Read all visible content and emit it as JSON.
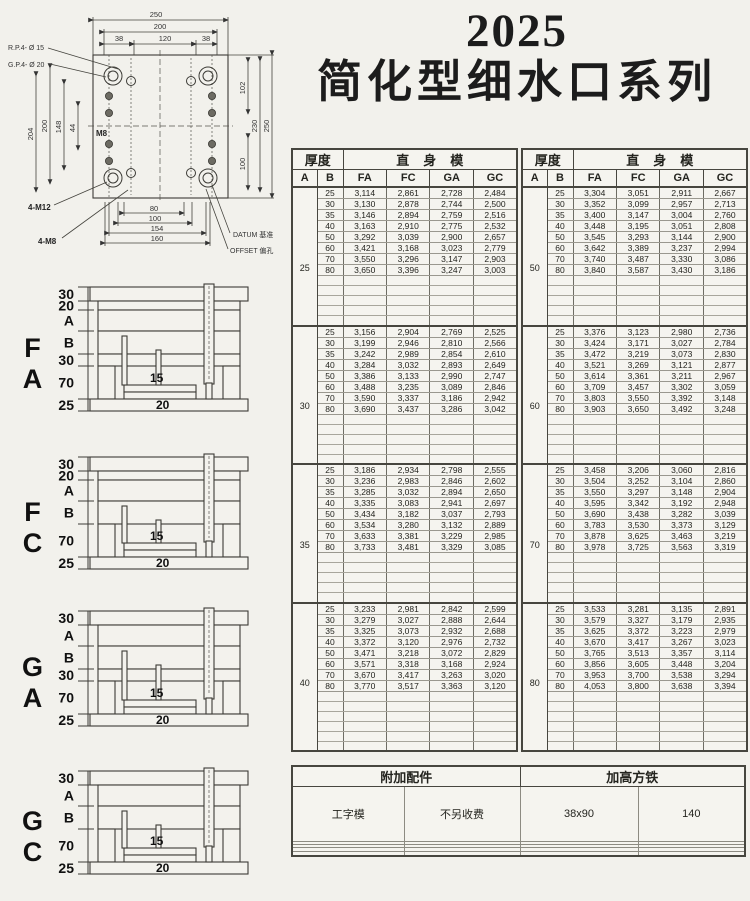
{
  "page": {
    "title_year": "2025",
    "title_main": "简化型细水口系列"
  },
  "drawing": {
    "dims": {
      "t250": "250",
      "t200": "200",
      "t38l": "38",
      "t120": "120",
      "t38r": "38",
      "l204": "204",
      "l200": "200",
      "l148": "148",
      "l44": "44",
      "r102": "102",
      "r230": "230",
      "r250": "250",
      "r100": "100",
      "b80": "80",
      "b100": "100",
      "b154": "154",
      "b160": "160",
      "m8": "M8"
    },
    "labels": {
      "rp": "R.P.4- Ø 15",
      "gp": "G.P.4- Ø 20",
      "m12": "4-M12",
      "m8b": "4-M8",
      "datum": "DATUM 基准",
      "offset": "OFFSET 偏孔"
    }
  },
  "diagrams": [
    {
      "label": "F A",
      "plates": [
        "30",
        "20",
        "A",
        "B",
        "30",
        "70",
        "25"
      ],
      "dim15": "15",
      "dim20": "20"
    },
    {
      "label": "F C",
      "plates": [
        "30",
        "20",
        "A",
        "B",
        "70",
        "25"
      ],
      "dim15": "15",
      "dim20": "20"
    },
    {
      "label": "G A",
      "plates": [
        "30",
        "A",
        "B",
        "30",
        "70",
        "25"
      ],
      "dim15": "15",
      "dim20": "20"
    },
    {
      "label": "G C",
      "plates": [
        "30",
        "A",
        "B",
        "70",
        "25"
      ],
      "dim15": "15",
      "dim20": "20"
    }
  ],
  "price_tables": {
    "header": {
      "thickness": "厚度",
      "model": "直身模",
      "a": "A",
      "b": "B",
      "series": [
        "FA",
        "FC",
        "GA",
        "GC"
      ]
    },
    "left_blocks": [
      {
        "a": "25",
        "empty": 5,
        "rows": [
          [
            "25",
            "3,114",
            "2,861",
            "2,728",
            "2,484"
          ],
          [
            "30",
            "3,130",
            "2,878",
            "2,744",
            "2,500"
          ],
          [
            "35",
            "3,146",
            "2,894",
            "2,759",
            "2,516"
          ],
          [
            "40",
            "3,163",
            "2,910",
            "2,775",
            "2,532"
          ],
          [
            "50",
            "3,292",
            "3,039",
            "2,900",
            "2,657"
          ],
          [
            "60",
            "3,421",
            "3,168",
            "3,023",
            "2,779"
          ],
          [
            "70",
            "3,550",
            "3,296",
            "3,147",
            "2,903"
          ],
          [
            "80",
            "3,650",
            "3,396",
            "3,247",
            "3,003"
          ]
        ]
      },
      {
        "a": "30",
        "empty": 5,
        "rows": [
          [
            "25",
            "3,156",
            "2,904",
            "2,769",
            "2,525"
          ],
          [
            "30",
            "3,199",
            "2,946",
            "2,810",
            "2,566"
          ],
          [
            "35",
            "3,242",
            "2,989",
            "2,854",
            "2,610"
          ],
          [
            "40",
            "3,284",
            "3,032",
            "2,893",
            "2,649"
          ],
          [
            "50",
            "3,386",
            "3,133",
            "2,990",
            "2,747"
          ],
          [
            "60",
            "3,488",
            "3,235",
            "3,089",
            "2,846"
          ],
          [
            "70",
            "3,590",
            "3,337",
            "3,186",
            "2,942"
          ],
          [
            "80",
            "3,690",
            "3,437",
            "3,286",
            "3,042"
          ]
        ]
      },
      {
        "a": "35",
        "empty": 5,
        "rows": [
          [
            "25",
            "3,186",
            "2,934",
            "2,798",
            "2,555"
          ],
          [
            "30",
            "3,236",
            "2,983",
            "2,846",
            "2,602"
          ],
          [
            "35",
            "3,285",
            "3,032",
            "2,894",
            "2,650"
          ],
          [
            "40",
            "3,335",
            "3,083",
            "2,941",
            "2,697"
          ],
          [
            "50",
            "3,434",
            "3,182",
            "3,037",
            "2,793"
          ],
          [
            "60",
            "3,534",
            "3,280",
            "3,132",
            "2,889"
          ],
          [
            "70",
            "3,633",
            "3,381",
            "3,229",
            "2,985"
          ],
          [
            "80",
            "3,733",
            "3,481",
            "3,329",
            "3,085"
          ]
        ]
      },
      {
        "a": "40",
        "empty": 6,
        "rows": [
          [
            "25",
            "3,233",
            "2,981",
            "2,842",
            "2,599"
          ],
          [
            "30",
            "3,279",
            "3,027",
            "2,888",
            "2,644"
          ],
          [
            "35",
            "3,325",
            "3,073",
            "2,932",
            "2,688"
          ],
          [
            "40",
            "3,372",
            "3,120",
            "2,976",
            "2,732"
          ],
          [
            "50",
            "3,471",
            "3,218",
            "3,072",
            "2,829"
          ],
          [
            "60",
            "3,571",
            "3,318",
            "3,168",
            "2,924"
          ],
          [
            "70",
            "3,670",
            "3,417",
            "3,263",
            "3,020"
          ],
          [
            "80",
            "3,770",
            "3,517",
            "3,363",
            "3,120"
          ]
        ]
      }
    ],
    "right_blocks": [
      {
        "a": "50",
        "empty": 5,
        "rows": [
          [
            "25",
            "3,304",
            "3,051",
            "2,911",
            "2,667"
          ],
          [
            "30",
            "3,352",
            "3,099",
            "2,957",
            "2,713"
          ],
          [
            "35",
            "3,400",
            "3,147",
            "3,004",
            "2,760"
          ],
          [
            "40",
            "3,448",
            "3,195",
            "3,051",
            "2,808"
          ],
          [
            "50",
            "3,545",
            "3,293",
            "3,144",
            "2,900"
          ],
          [
            "60",
            "3,642",
            "3,389",
            "3,237",
            "2,994"
          ],
          [
            "70",
            "3,740",
            "3,487",
            "3,330",
            "3,086"
          ],
          [
            "80",
            "3,840",
            "3,587",
            "3,430",
            "3,186"
          ]
        ]
      },
      {
        "a": "60",
        "empty": 5,
        "rows": [
          [
            "25",
            "3,376",
            "3,123",
            "2,980",
            "2,736"
          ],
          [
            "30",
            "3,424",
            "3,171",
            "3,027",
            "2,784"
          ],
          [
            "35",
            "3,472",
            "3,219",
            "3,073",
            "2,830"
          ],
          [
            "40",
            "3,521",
            "3,269",
            "3,121",
            "2,877"
          ],
          [
            "50",
            "3,614",
            "3,361",
            "3,211",
            "2,967"
          ],
          [
            "60",
            "3,709",
            "3,457",
            "3,302",
            "3,059"
          ],
          [
            "70",
            "3,803",
            "3,550",
            "3,392",
            "3,148"
          ],
          [
            "80",
            "3,903",
            "3,650",
            "3,492",
            "3,248"
          ]
        ]
      },
      {
        "a": "70",
        "empty": 5,
        "rows": [
          [
            "25",
            "3,458",
            "3,206",
            "3,060",
            "2,816"
          ],
          [
            "30",
            "3,504",
            "3,252",
            "3,104",
            "2,860"
          ],
          [
            "35",
            "3,550",
            "3,297",
            "3,148",
            "2,904"
          ],
          [
            "40",
            "3,595",
            "3,342",
            "3,192",
            "2,948"
          ],
          [
            "50",
            "3,690",
            "3,438",
            "3,282",
            "3,039"
          ],
          [
            "60",
            "3,783",
            "3,530",
            "3,373",
            "3,129"
          ],
          [
            "70",
            "3,878",
            "3,625",
            "3,463",
            "3,219"
          ],
          [
            "80",
            "3,978",
            "3,725",
            "3,563",
            "3,319"
          ]
        ]
      },
      {
        "a": "80",
        "empty": 6,
        "rows": [
          [
            "25",
            "3,533",
            "3,281",
            "3,135",
            "2,891"
          ],
          [
            "30",
            "3,579",
            "3,327",
            "3,179",
            "2,935"
          ],
          [
            "35",
            "3,625",
            "3,372",
            "3,223",
            "2,979"
          ],
          [
            "40",
            "3,670",
            "3,417",
            "3,267",
            "3,023"
          ],
          [
            "50",
            "3,765",
            "3,513",
            "3,357",
            "3,114"
          ],
          [
            "60",
            "3,856",
            "3,605",
            "3,448",
            "3,204"
          ],
          [
            "70",
            "3,953",
            "3,700",
            "3,538",
            "3,294"
          ],
          [
            "80",
            "4,053",
            "3,800",
            "3,638",
            "3,394"
          ]
        ]
      }
    ]
  },
  "accessories": {
    "header_left": "附加配件",
    "header_right": "加高方铁",
    "cells": [
      "工字模",
      "不另收费",
      "38x90",
      "140"
    ],
    "empty_row_count": 4
  }
}
